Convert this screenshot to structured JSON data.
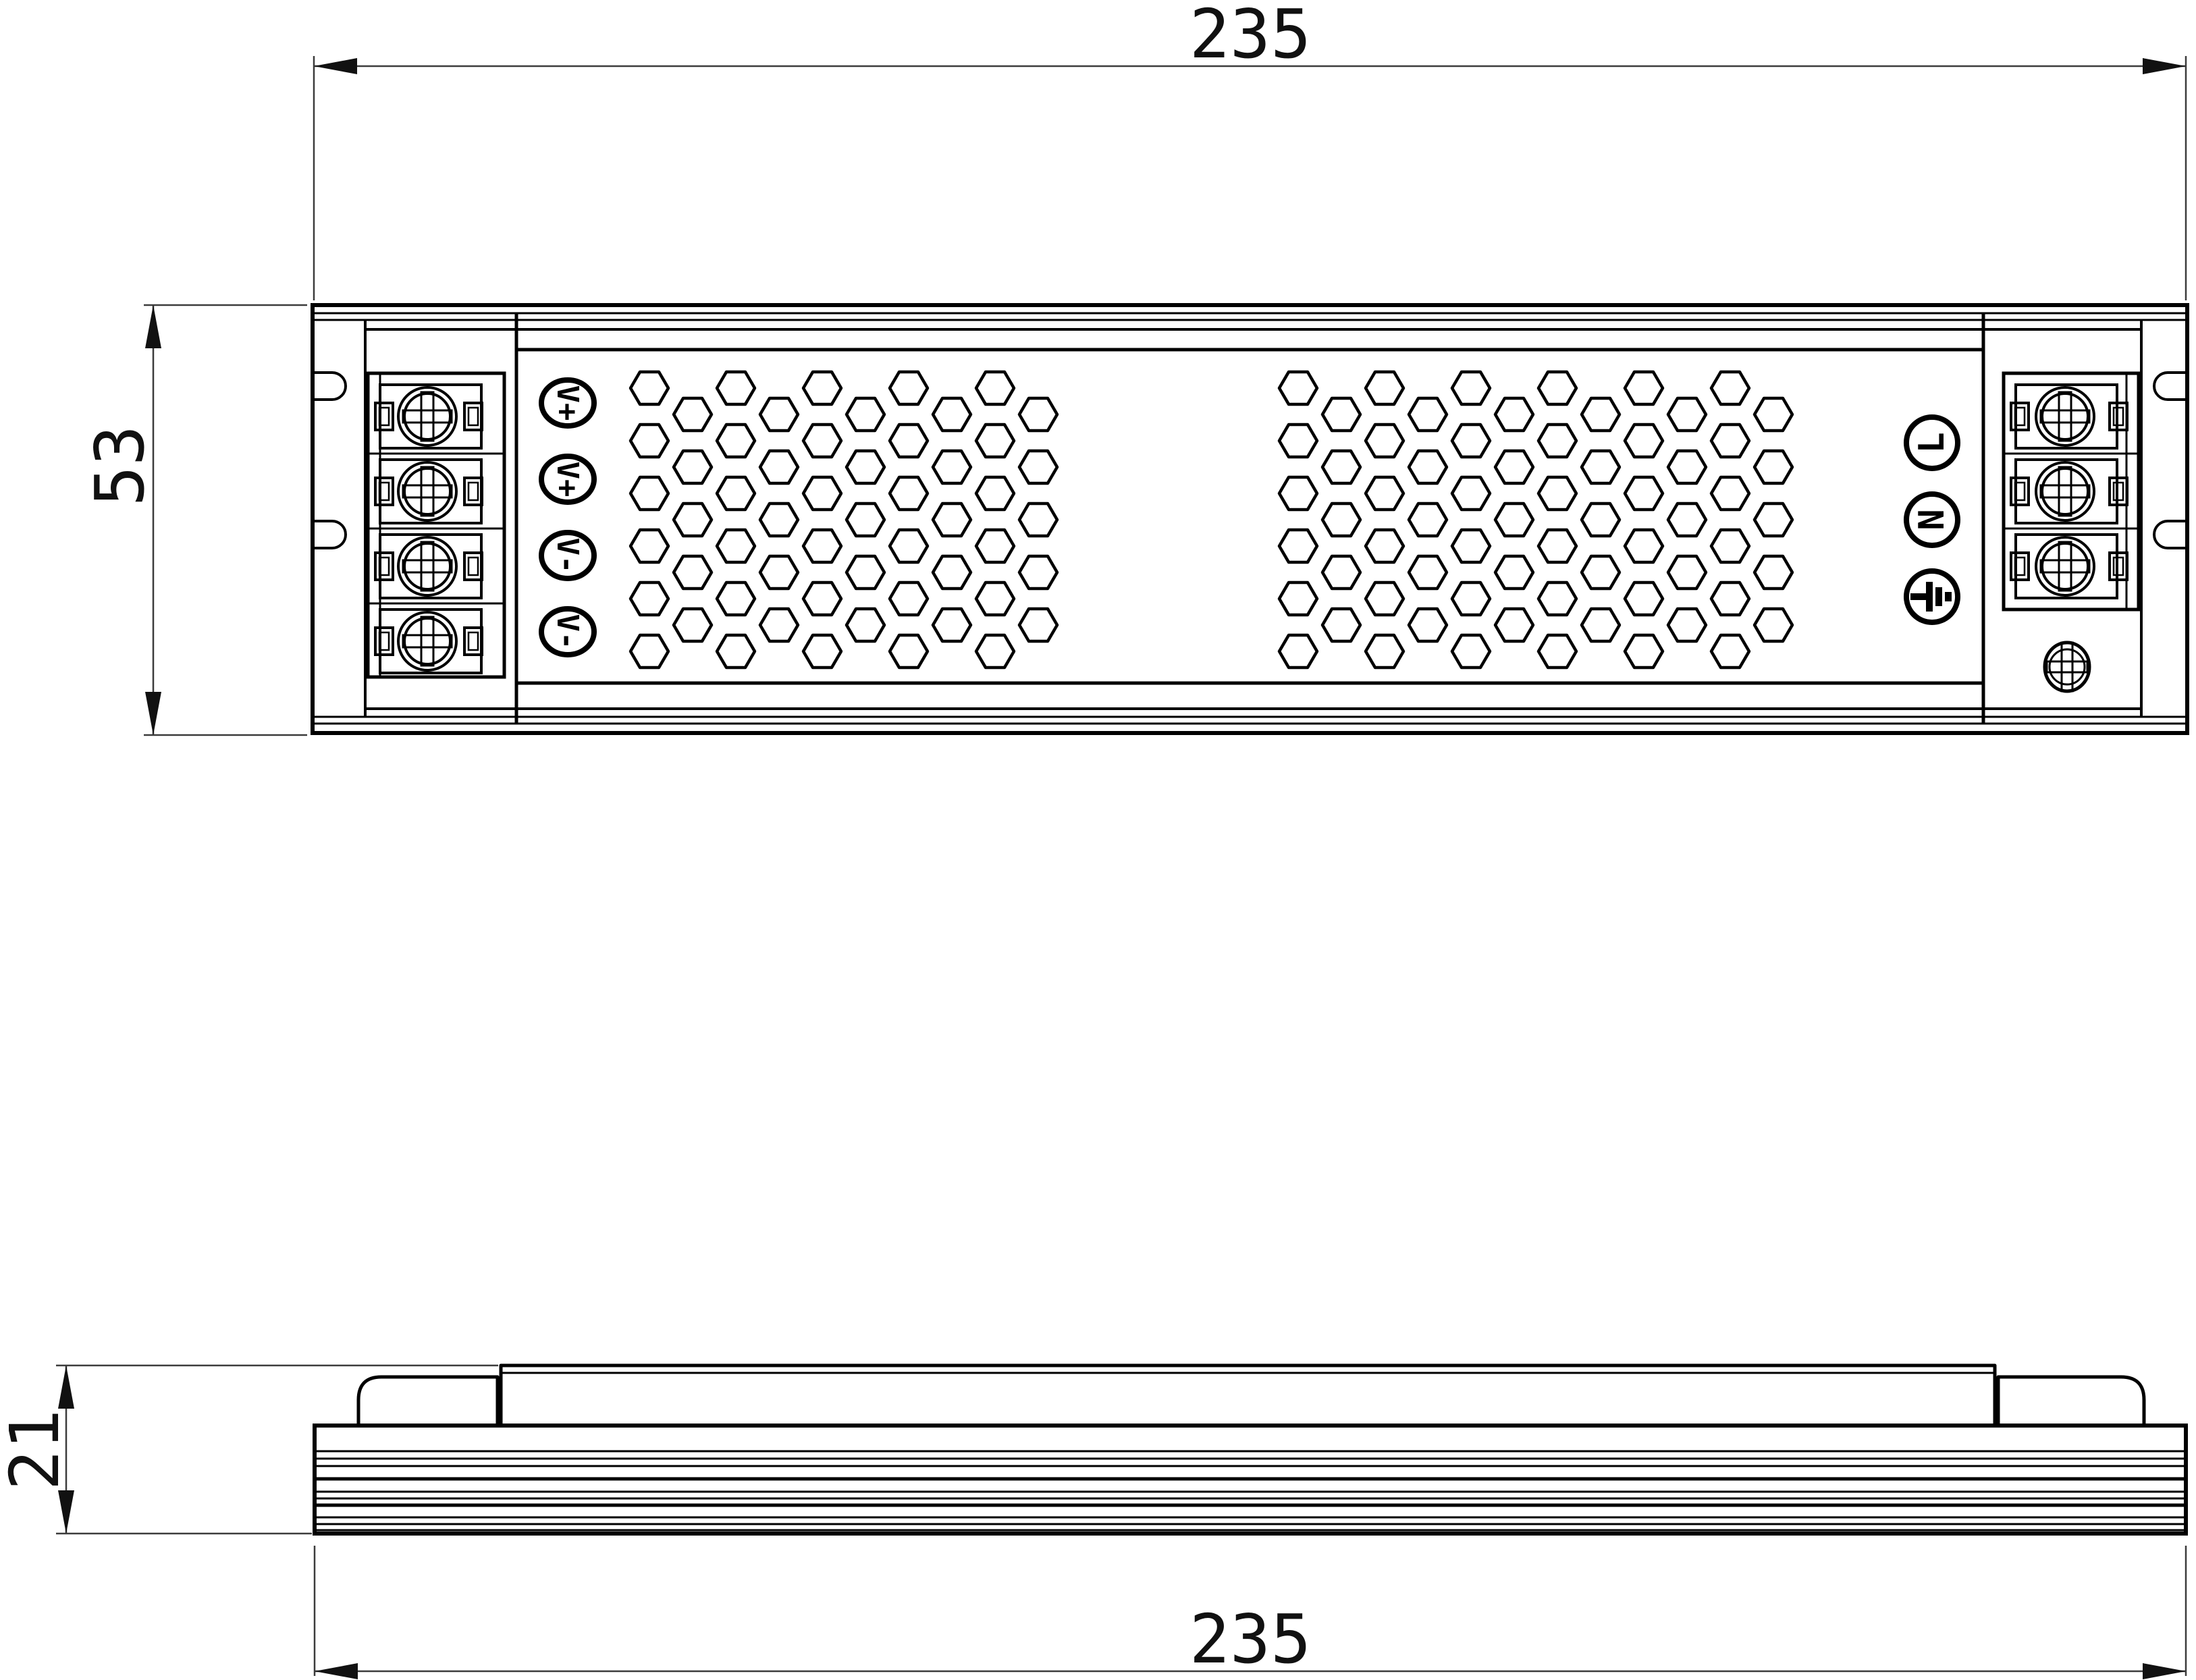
{
  "dimensions": {
    "top_width": "235",
    "left_height": "53",
    "side_height": "21",
    "bottom_width": "235"
  },
  "terminals": {
    "output": {
      "labels": [
        "V+",
        "V+",
        "V-",
        "V-"
      ]
    },
    "input": {
      "labels": [
        "L",
        "N"
      ],
      "ground_icon": "earth-ground"
    }
  },
  "vents": {
    "shape": "hexagon",
    "patches": 2
  },
  "colors": {
    "line": "#000000",
    "dim_line": "#3c3c3c",
    "arrow": "#111111",
    "background": "#ffffff"
  }
}
